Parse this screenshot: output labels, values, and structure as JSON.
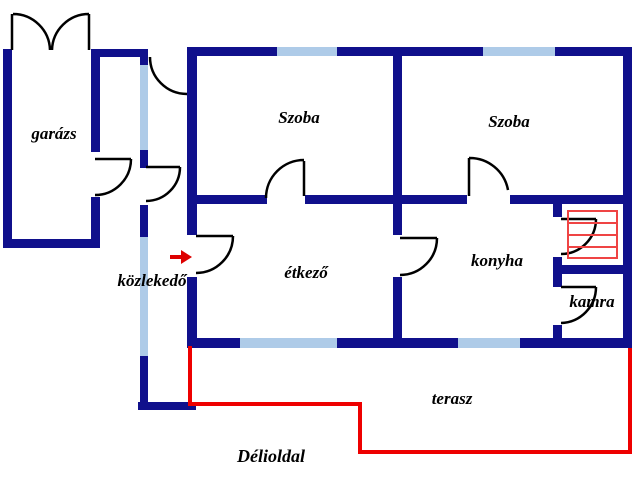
{
  "rooms": {
    "garage": "garázs",
    "room1": "Szoba",
    "room2": "Szoba",
    "hallway": "közlekedő",
    "dining": "étkező",
    "kitchen": "konyha",
    "pantry": "kamra",
    "terrace": "terasz"
  },
  "annotations": {
    "south_side": "Délioldal"
  },
  "colors": {
    "wall": "#10108c",
    "window": "#aecbe8",
    "door": "#000000",
    "terrace": "#ee0000",
    "stairs": "#ef4444",
    "arrow": "#dd0000",
    "text": "#000000",
    "background": "#ffffff"
  }
}
